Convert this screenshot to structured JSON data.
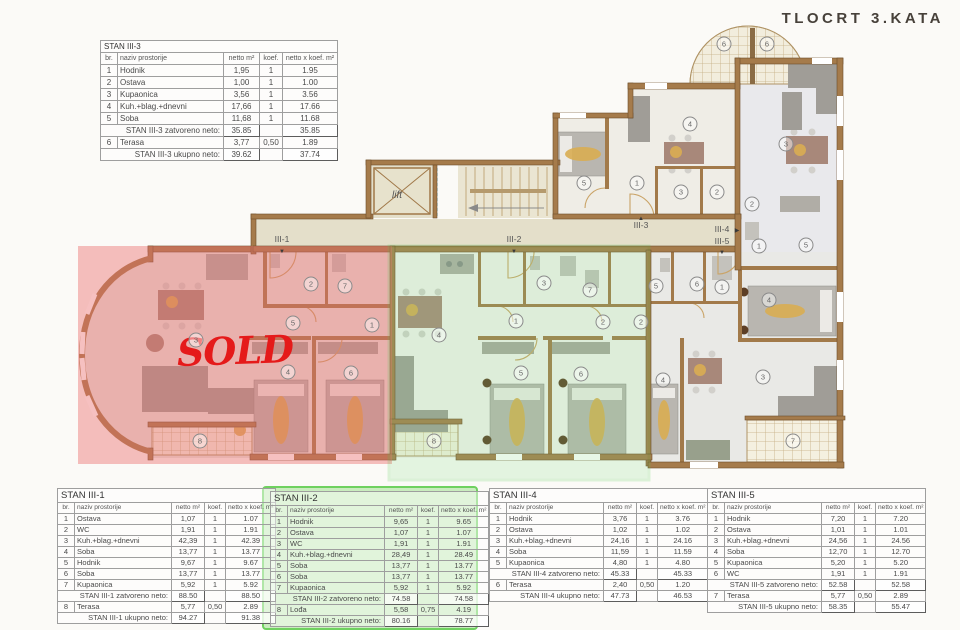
{
  "title": "TLOCRT 3.KATA",
  "plan": {
    "sold_label": "SOLD",
    "lift_label": "lift",
    "apartment_labels": [
      {
        "label": "III-1",
        "x": 282,
        "y": 242,
        "arrow": "▼",
        "ax": 282,
        "ay": 253
      },
      {
        "label": "III-2",
        "x": 514,
        "y": 242,
        "arrow": "▼",
        "ax": 514,
        "ay": 253
      },
      {
        "label": "III-3",
        "x": 641,
        "y": 228,
        "arrow": "▲",
        "ax": 641,
        "ay": 220
      },
      {
        "label": "III-4",
        "x": 722,
        "y": 232,
        "arrow": "▶",
        "ax": 737,
        "ay": 232
      },
      {
        "label": "III-5",
        "x": 722,
        "y": 244,
        "arrow": "▼",
        "ax": 722,
        "ay": 254
      }
    ],
    "room_markers": [
      {
        "n": "2",
        "x": 311,
        "y": 284
      },
      {
        "n": "7",
        "x": 345,
        "y": 286
      },
      {
        "n": "5",
        "x": 293,
        "y": 323
      },
      {
        "n": "1",
        "x": 372,
        "y": 325
      },
      {
        "n": "3",
        "x": 196,
        "y": 340
      },
      {
        "n": "4",
        "x": 288,
        "y": 372
      },
      {
        "n": "6",
        "x": 351,
        "y": 373
      },
      {
        "n": "8",
        "x": 200,
        "y": 441
      },
      {
        "n": "3",
        "x": 544,
        "y": 283
      },
      {
        "n": "7",
        "x": 590,
        "y": 290
      },
      {
        "n": "1",
        "x": 516,
        "y": 321
      },
      {
        "n": "2",
        "x": 603,
        "y": 322
      },
      {
        "n": "2",
        "x": 641,
        "y": 322
      },
      {
        "n": "4",
        "x": 439,
        "y": 335
      },
      {
        "n": "5",
        "x": 521,
        "y": 373
      },
      {
        "n": "6",
        "x": 581,
        "y": 374
      },
      {
        "n": "8",
        "x": 434,
        "y": 441
      },
      {
        "n": "4",
        "x": 690,
        "y": 124
      },
      {
        "n": "5",
        "x": 584,
        "y": 183
      },
      {
        "n": "1",
        "x": 637,
        "y": 183
      },
      {
        "n": "3",
        "x": 681,
        "y": 192
      },
      {
        "n": "2",
        "x": 717,
        "y": 192
      },
      {
        "n": "6",
        "x": 724,
        "y": 44
      },
      {
        "n": "3",
        "x": 786,
        "y": 144
      },
      {
        "n": "2",
        "x": 752,
        "y": 204
      },
      {
        "n": "1",
        "x": 759,
        "y": 246
      },
      {
        "n": "5",
        "x": 806,
        "y": 245
      },
      {
        "n": "4",
        "x": 769,
        "y": 300
      },
      {
        "n": "6",
        "x": 767,
        "y": 44
      },
      {
        "n": "5",
        "x": 656,
        "y": 286
      },
      {
        "n": "6",
        "x": 697,
        "y": 284
      },
      {
        "n": "1",
        "x": 722,
        "y": 287
      },
      {
        "n": "3",
        "x": 763,
        "y": 377
      },
      {
        "n": "4",
        "x": 663,
        "y": 380
      },
      {
        "n": "7",
        "x": 793,
        "y": 441
      }
    ]
  },
  "tables": {
    "stan_iii_3": {
      "title": "STAN III-3",
      "headers": [
        "br.",
        "naziv prostorije",
        "netto m²",
        "koef.",
        "netto x koef. m²"
      ],
      "rows": [
        [
          "1",
          "Hodnik",
          "1,95",
          "1",
          "1.95"
        ],
        [
          "2",
          "Ostava",
          "1,00",
          "1",
          "1.00"
        ],
        [
          "3",
          "Kupaonica",
          "3,56",
          "1",
          "3.56"
        ],
        [
          "4",
          "Kuh.+blag.+dnevni",
          "17,66",
          "1",
          "17.66"
        ],
        [
          "5",
          "Soba",
          "11,68",
          "1",
          "11.68"
        ],
        {
          "label": "STAN III-3 zatvoreno neto:",
          "v1": "35.85",
          "v2": "35.85"
        },
        [
          "6",
          "Terasa",
          "3,77",
          "0,50",
          "1.89"
        ],
        {
          "label": "STAN III-3 ukupno neto:",
          "v1": "39.62",
          "v2": "37.74"
        }
      ]
    },
    "stan_iii_1": {
      "title": "STAN III-1",
      "headers": [
        "br.",
        "naziv prostorije",
        "netto m²",
        "koef.",
        "netto x koef. m²"
      ],
      "rows": [
        [
          "1",
          "Ostava",
          "1,07",
          "1",
          "1.07"
        ],
        [
          "2",
          "WC",
          "1,91",
          "1",
          "1.91"
        ],
        [
          "3",
          "Kuh.+blag.+dnevni",
          "42,39",
          "1",
          "42.39"
        ],
        [
          "4",
          "Soba",
          "13,77",
          "1",
          "13.77"
        ],
        [
          "5",
          "Hodnik",
          "9,67",
          "1",
          "9.67"
        ],
        [
          "6",
          "Soba",
          "13,77",
          "1",
          "13.77"
        ],
        [
          "7",
          "Kupaonica",
          "5,92",
          "1",
          "5.92"
        ],
        {
          "label": "STAN III-1 zatvoreno neto:",
          "v1": "88.50",
          "v2": "88.50"
        },
        [
          "8",
          "Terasa",
          "5,77",
          "0,50",
          "2.89"
        ],
        {
          "label": "STAN III-1 ukupno neto:",
          "v1": "94.27",
          "v2": "91.38"
        }
      ]
    },
    "stan_iii_2": {
      "title": "STAN III-2",
      "headers": [
        "br.",
        "naziv prostorije",
        "netto m²",
        "koef.",
        "netto x koef. m²"
      ],
      "rows": [
        [
          "1",
          "Hodnik",
          "9,65",
          "1",
          "9.65"
        ],
        [
          "2",
          "Ostava",
          "1,07",
          "1",
          "1.07"
        ],
        [
          "3",
          "WC",
          "1,91",
          "1",
          "1.91"
        ],
        [
          "4",
          "Kuh.+blag.+dnevni",
          "28,49",
          "1",
          "28.49"
        ],
        [
          "5",
          "Soba",
          "13,77",
          "1",
          "13.77"
        ],
        [
          "6",
          "Soba",
          "13,77",
          "1",
          "13.77"
        ],
        [
          "7",
          "Kupaonica",
          "5,92",
          "1",
          "5.92"
        ],
        {
          "label": "STAN III-2 zatvoreno neto:",
          "v1": "74.58",
          "v2": "74.58"
        },
        [
          "8",
          "Lođa",
          "5,58",
          "0,75",
          "4.19"
        ],
        {
          "label": "STAN III-2 ukupno neto:",
          "v1": "80.16",
          "v2": "78.77"
        }
      ]
    },
    "stan_iii_4": {
      "title": "STAN III-4",
      "headers": [
        "br.",
        "naziv prostorije",
        "netto m²",
        "koef.",
        "netto x koef. m²"
      ],
      "rows": [
        [
          "1",
          "Hodnik",
          "3,76",
          "1",
          "3.76"
        ],
        [
          "2",
          "Ostava",
          "1,02",
          "1",
          "1.02"
        ],
        [
          "3",
          "Kuh.+blag.+dnevni",
          "24,16",
          "1",
          "24.16"
        ],
        [
          "4",
          "Soba",
          "11,59",
          "1",
          "11.59"
        ],
        [
          "5",
          "Kupaonica",
          "4,80",
          "1",
          "4.80"
        ],
        {
          "label": "STAN III-4 zatvoreno neto:",
          "v1": "45.33",
          "v2": "45.33"
        },
        [
          "6",
          "Terasa",
          "2,40",
          "0,50",
          "1.20"
        ],
        {
          "label": "STAN III-4 ukupno neto:",
          "v1": "47.73",
          "v2": "46.53"
        }
      ]
    },
    "stan_iii_5": {
      "title": "STAN III-5",
      "headers": [
        "br.",
        "naziv prostorije",
        "netto m²",
        "koef.",
        "netto x koef. m²"
      ],
      "rows": [
        [
          "1",
          "Hodnik",
          "7,20",
          "1",
          "7.20"
        ],
        [
          "2",
          "Ostava",
          "1,01",
          "1",
          "1.01"
        ],
        [
          "3",
          "Kuh.+blag.+dnevni",
          "24,56",
          "1",
          "24.56"
        ],
        [
          "4",
          "Soba",
          "12,70",
          "1",
          "12.70"
        ],
        [
          "5",
          "Kupaonica",
          "5,20",
          "1",
          "5.20"
        ],
        [
          "6",
          "WC",
          "1,91",
          "1",
          "1.91"
        ],
        {
          "label": "STAN III-5 zatvoreno neto:",
          "v1": "52.58",
          "v2": "52.58"
        },
        [
          "7",
          "Terasa",
          "5,77",
          "0,50",
          "2.89"
        ],
        {
          "label": "STAN III-5 ukupno neto:",
          "v1": "58.35",
          "v2": "55.47"
        }
      ]
    }
  }
}
